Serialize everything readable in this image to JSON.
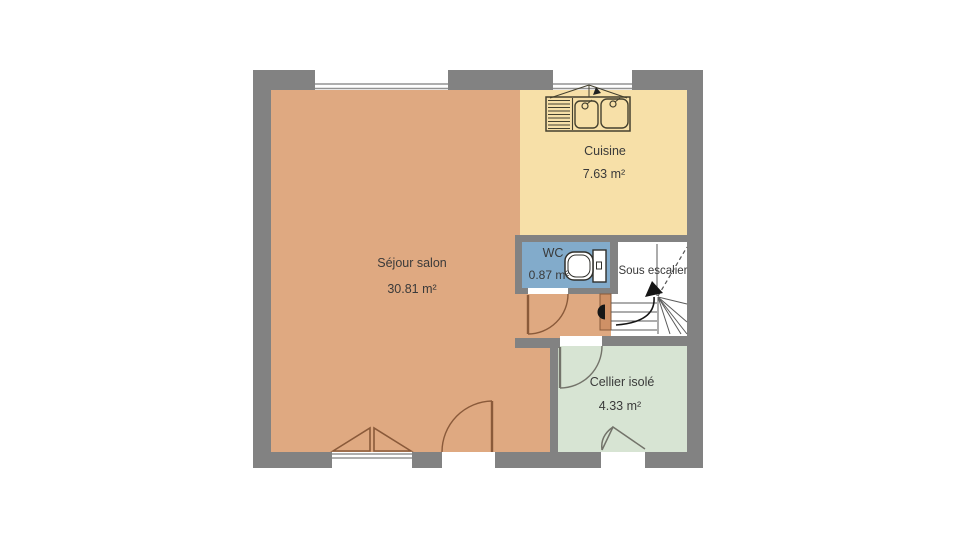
{
  "plan": {
    "type": "floor-plan",
    "background": "#ffffff",
    "wall_color": "#828282",
    "rooms": {
      "sejour": {
        "label": "Séjour salon",
        "area": "30.81 m²",
        "color": "#dfa981"
      },
      "cuisine": {
        "label": "Cuisine",
        "area": "7.63 m²",
        "color": "#f7e0a8"
      },
      "wc": {
        "label": "WC",
        "area": "0.87 m²",
        "color": "#82abcb"
      },
      "escalier": {
        "label": "Sous escalier",
        "color": "#ffffff"
      },
      "cellier": {
        "label": "Cellier isolé",
        "area": "4.33 m²",
        "color": "#d7e4d3"
      }
    },
    "icons": {
      "sink": "double-kitchen-sink-with-drainboard",
      "toilet": "toilet-with-cistern",
      "stairs": "winder-staircase-with-up-arrow"
    }
  }
}
